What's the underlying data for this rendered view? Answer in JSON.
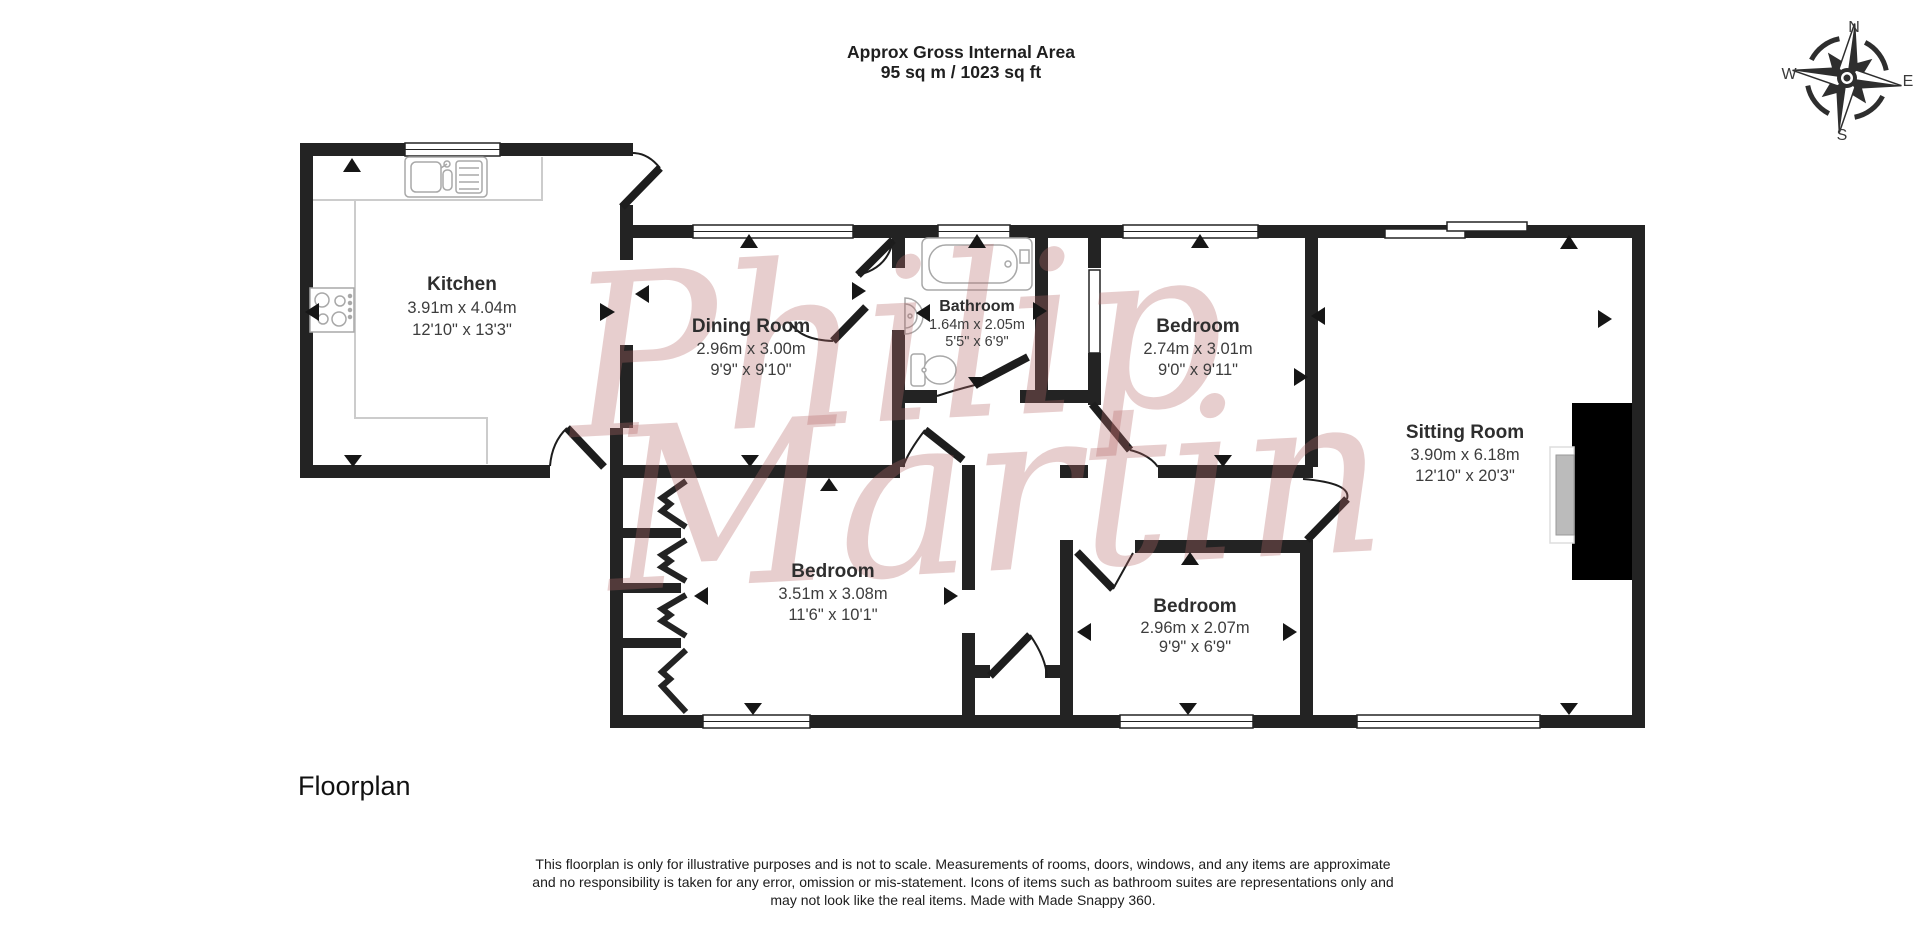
{
  "header": {
    "line1": "Approx Gross Internal Area",
    "line2": "95 sq m / 1023 sq ft"
  },
  "rooms": [
    {
      "name": "Kitchen",
      "metric": "3.91m x 4.04m",
      "imperial": "12'10\" x 13'3\""
    },
    {
      "name": "Dining Room",
      "metric": "2.96m x 3.00m",
      "imperial": "9'9\" x 9'10\""
    },
    {
      "name": "Bathroom",
      "metric": "1.64m x 2.05m",
      "imperial": "5'5\" x 6'9\""
    },
    {
      "name": "Bedroom",
      "metric": "2.74m x 3.01m",
      "imperial": "9'0\" x 9'11\""
    },
    {
      "name": "Sitting Room",
      "metric": "3.90m x 6.18m",
      "imperial": "12'10\" x 20'3\""
    },
    {
      "name": "Bedroom",
      "metric": "3.51m x 3.08m",
      "imperial": "11'6\" x 10'1\""
    },
    {
      "name": "Bedroom",
      "metric": "2.96m x 2.07m",
      "imperial": "9'9\" x 6'9\""
    }
  ],
  "compass": {
    "n": "N",
    "e": "E",
    "s": "S",
    "w": "W"
  },
  "watermark": {
    "line1": "Philip",
    "line2": "Martin"
  },
  "footer": {
    "caption": "Floorplan",
    "disclaimer1": "This floorplan is only for illustrative purposes and is not to scale. Measurements of rooms, doors, windows, and any items are approximate",
    "disclaimer2": "and no responsibility is taken for any error, omission or mis-statement. Icons of items such as bathroom suites are representations only and",
    "disclaimer3": "may not look like the real items. Made with Made Snappy 360."
  },
  "colors": {
    "wall": "#232323",
    "watermark_pink": "#b76a6a",
    "fixture_gray": "#a8a8a8",
    "fireplace_gray": "#bbbbbb"
  }
}
